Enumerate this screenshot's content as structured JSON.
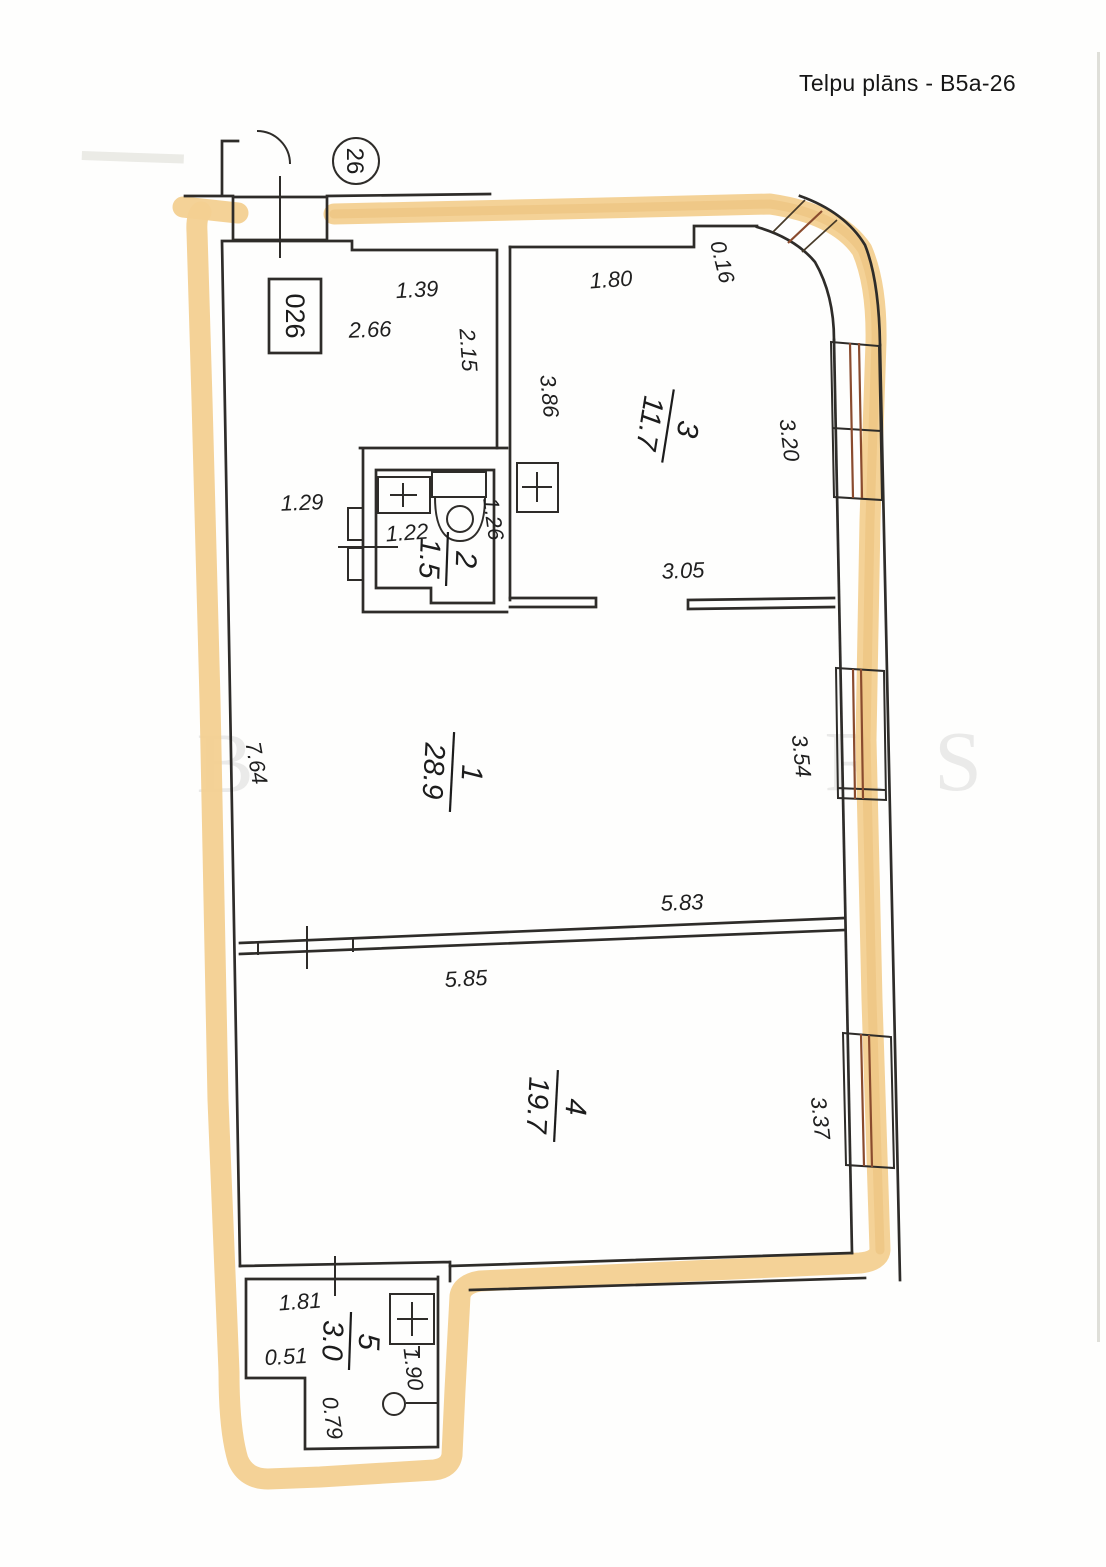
{
  "header": {
    "title": "Telpu plāns -  B5a-26"
  },
  "plan": {
    "stairwell_circle_label": "26",
    "unit_box_label": "026",
    "rooms": [
      {
        "number": "1",
        "area": "28.9"
      },
      {
        "number": "2",
        "area": "1.5"
      },
      {
        "number": "3",
        "area": "11.7"
      },
      {
        "number": "4",
        "area": "19.7"
      },
      {
        "number": "5",
        "area": "3.0"
      }
    ],
    "dimensions": {
      "entry_width": "1.39",
      "hall_266": "2.66",
      "hall_215": "2.15",
      "hall_129": "1.29",
      "room3_180": "1.80",
      "room3_016": "0.16",
      "room3_386": "3.86",
      "room3_320": "3.20",
      "room3_305": "3.05",
      "bath_122": "1.22",
      "bath_126": "1.26",
      "room1_764": "7.64",
      "room1_354": "3.54",
      "room1_583": "5.83",
      "room4_585": "5.85",
      "room4_337": "3.37",
      "room5_181": "1.81",
      "room5_051": "0.51",
      "room5_190": "1.90",
      "room5_079": "0.79"
    },
    "watermark_letters": [
      "B",
      "R",
      "S"
    ]
  }
}
